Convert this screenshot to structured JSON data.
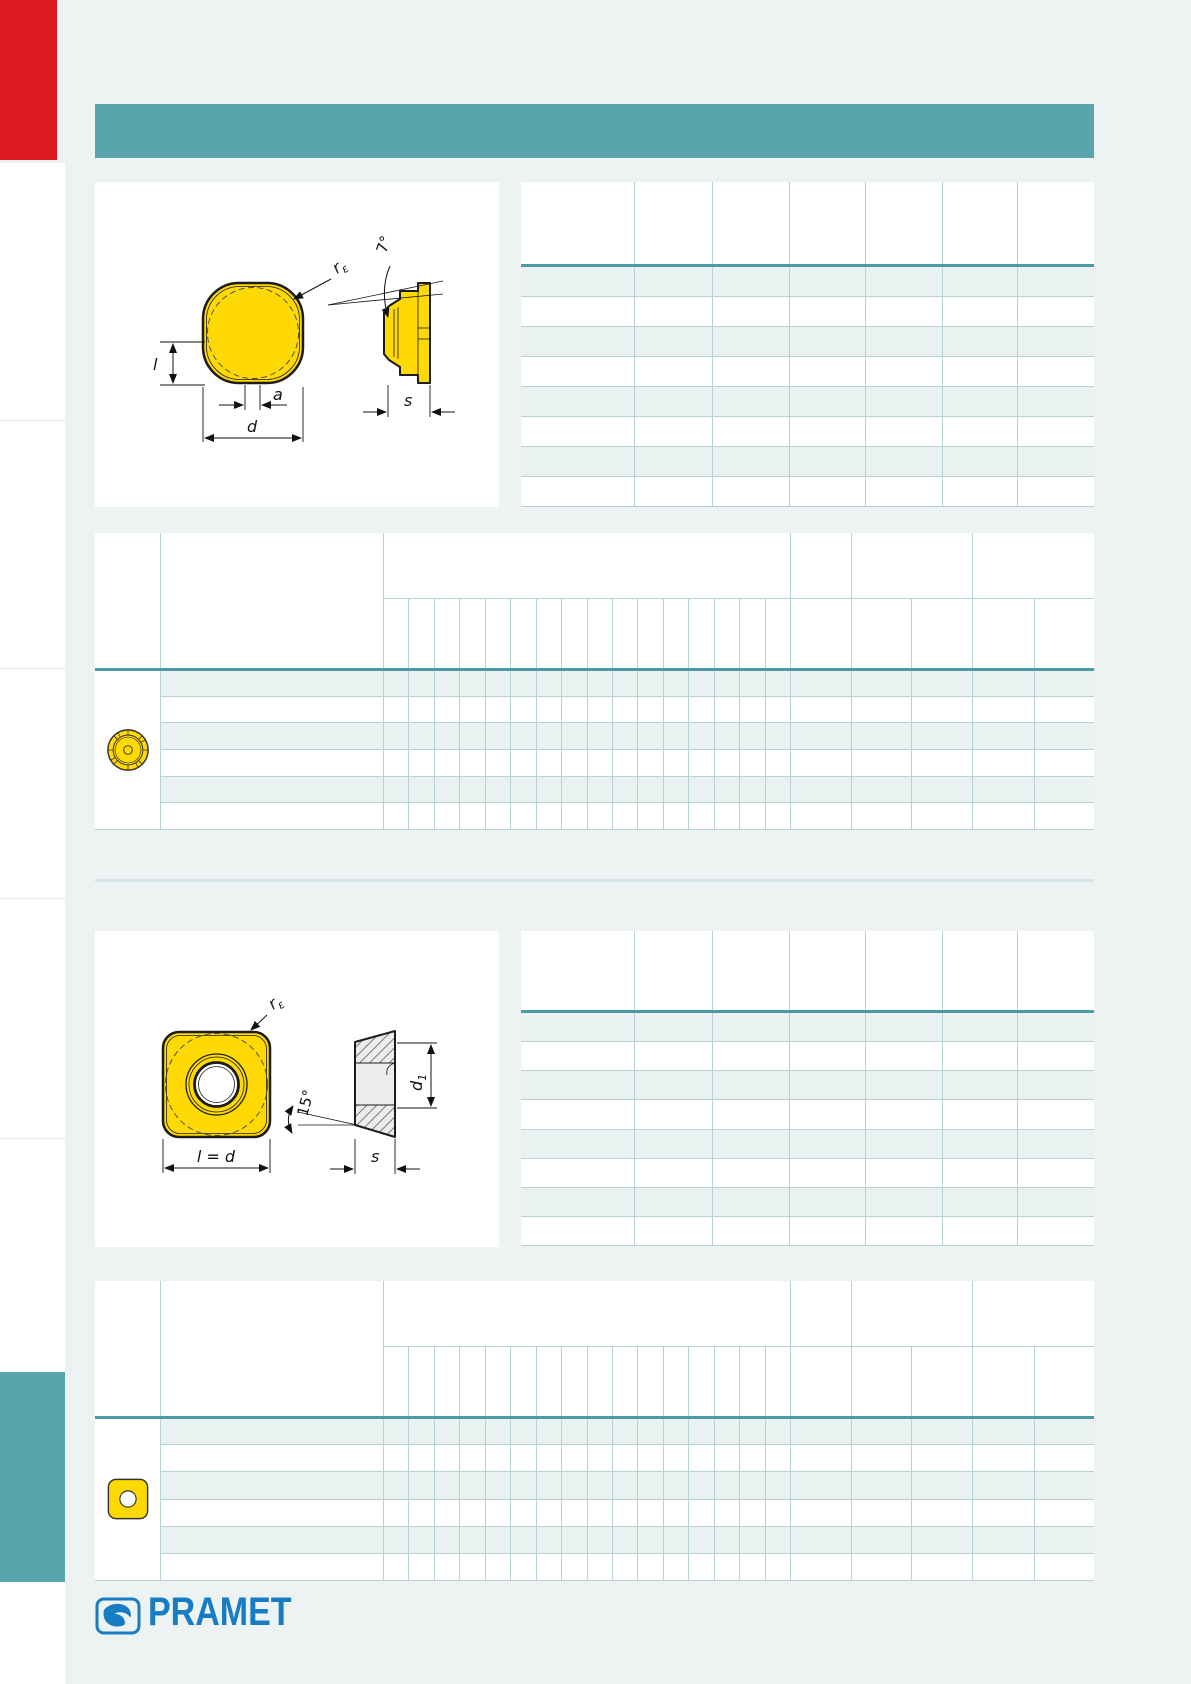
{
  "page": {
    "width": 1191,
    "height": 1684,
    "background": "#edf2f2"
  },
  "colors": {
    "accent_red": "#de1b21",
    "accent_teal": "#58a6ac",
    "table_strong_line": "#4d9aa2",
    "table_grid_line": "#b7d2d5",
    "row_tint": "#eaf1f1",
    "section_divider": "#d4e3e5",
    "insert_yellow": "#ffd903",
    "logo_blue": "#187cc3"
  },
  "header": {
    "band_text": ""
  },
  "sections": [
    {
      "name": "round insert",
      "drawing": {
        "icon": "round-insert-drawing",
        "labels": {
          "radius_symbol": "r",
          "radius_sub": "ε",
          "length": "l",
          "flat_width": "a",
          "diameter": "d",
          "clearance_angle": "7°",
          "thickness": "s"
        }
      },
      "spec_table": {
        "columns": 7,
        "data_rows": 8,
        "cells_empty": true
      },
      "main_table": {
        "icon": "round-insert-icon",
        "narrow_columns": 16,
        "data_rows": 6,
        "cells_empty": true
      }
    },
    {
      "name": "square insert",
      "drawing": {
        "icon": "square-insert-drawing",
        "labels": {
          "radius_symbol": "r",
          "radius_sub": "ε",
          "size_equation": "l = d",
          "ramp_angle": "15°",
          "thickness": "s",
          "hole_symbol": "d",
          "hole_sub": "1"
        }
      },
      "spec_table": {
        "columns": 7,
        "data_rows": 8,
        "cells_empty": true
      },
      "main_table": {
        "icon": "square-insert-icon",
        "narrow_columns": 16,
        "data_rows": 6,
        "cells_empty": true
      }
    }
  ],
  "footer": {
    "logo_text": "PRAMET"
  }
}
